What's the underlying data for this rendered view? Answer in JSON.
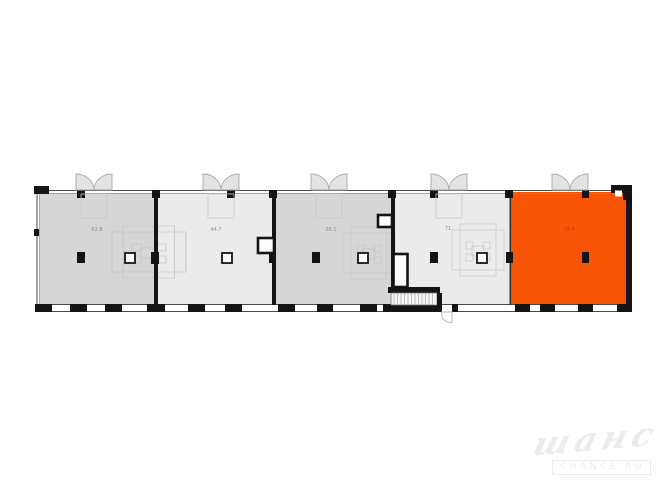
{
  "canvas": {
    "width": 670,
    "height": 503
  },
  "colors": {
    "accent_orange": "#F85506",
    "room_gray_dark": "#D6D6D6",
    "room_gray_light": "#EBEBEB",
    "wall_black": "#141414",
    "door_fill": "#E3E3E3",
    "label_gray": "#8F8F8F",
    "label_on_accent": "#B84000",
    "watermark": "#ECECEC"
  },
  "floorplan": {
    "description": "single-storey strip plan, five units, rightmost unit highlighted",
    "rooms": [
      {
        "id": "room-1",
        "area_label": "62.8",
        "fill": "gray_dark",
        "highlighted": false
      },
      {
        "id": "room-2",
        "area_label": "44.7",
        "fill": "gray_light",
        "highlighted": false
      },
      {
        "id": "room-3",
        "area_label": "36.1",
        "fill": "gray_dark",
        "highlighted": false
      },
      {
        "id": "room-4",
        "area_label": "71",
        "fill": "gray_light",
        "highlighted": false
      },
      {
        "id": "room-5",
        "area_label": "78.4",
        "fill": "accent",
        "highlighted": true
      }
    ]
  },
  "watermark": {
    "script_text": "шанс",
    "caption": "CHANCE.RU"
  }
}
